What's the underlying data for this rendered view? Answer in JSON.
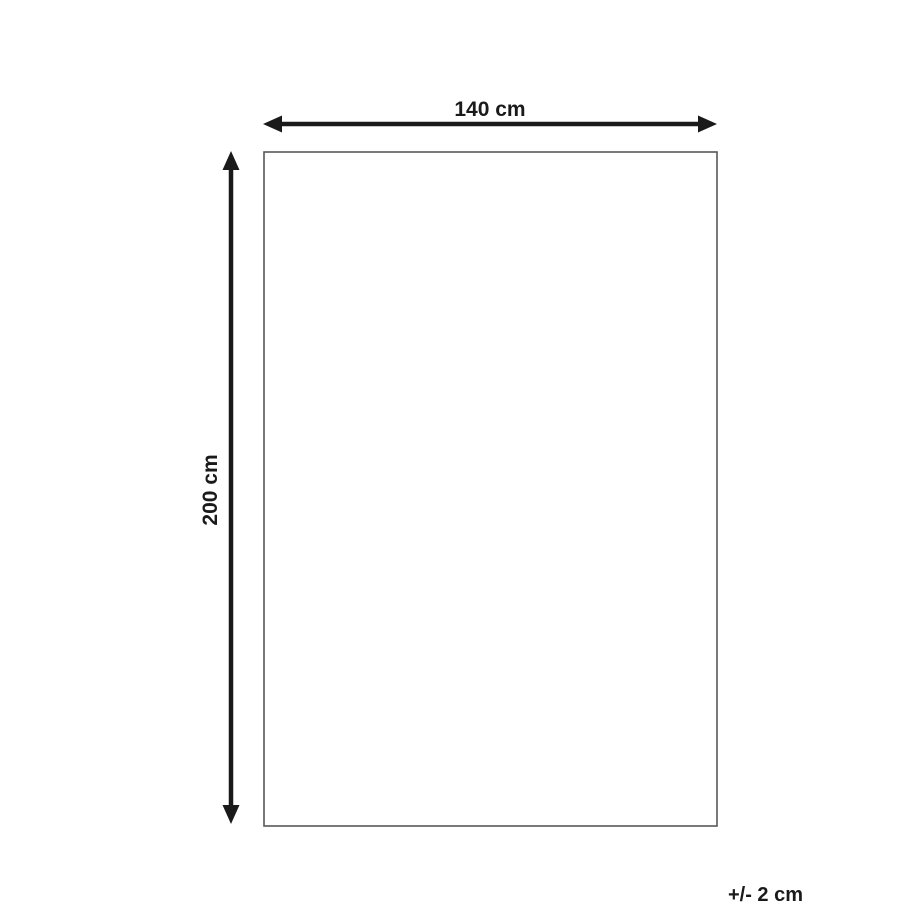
{
  "diagram": {
    "title": "product-dimension-diagram",
    "width_label": "140 cm",
    "height_label": "200 cm",
    "tolerance_label": "+/- 2 cm",
    "colors": {
      "arrow": "#1a1a1a",
      "text": "#1a1a1a",
      "rect_border": "#58585a",
      "background": "#ffffff"
    }
  }
}
